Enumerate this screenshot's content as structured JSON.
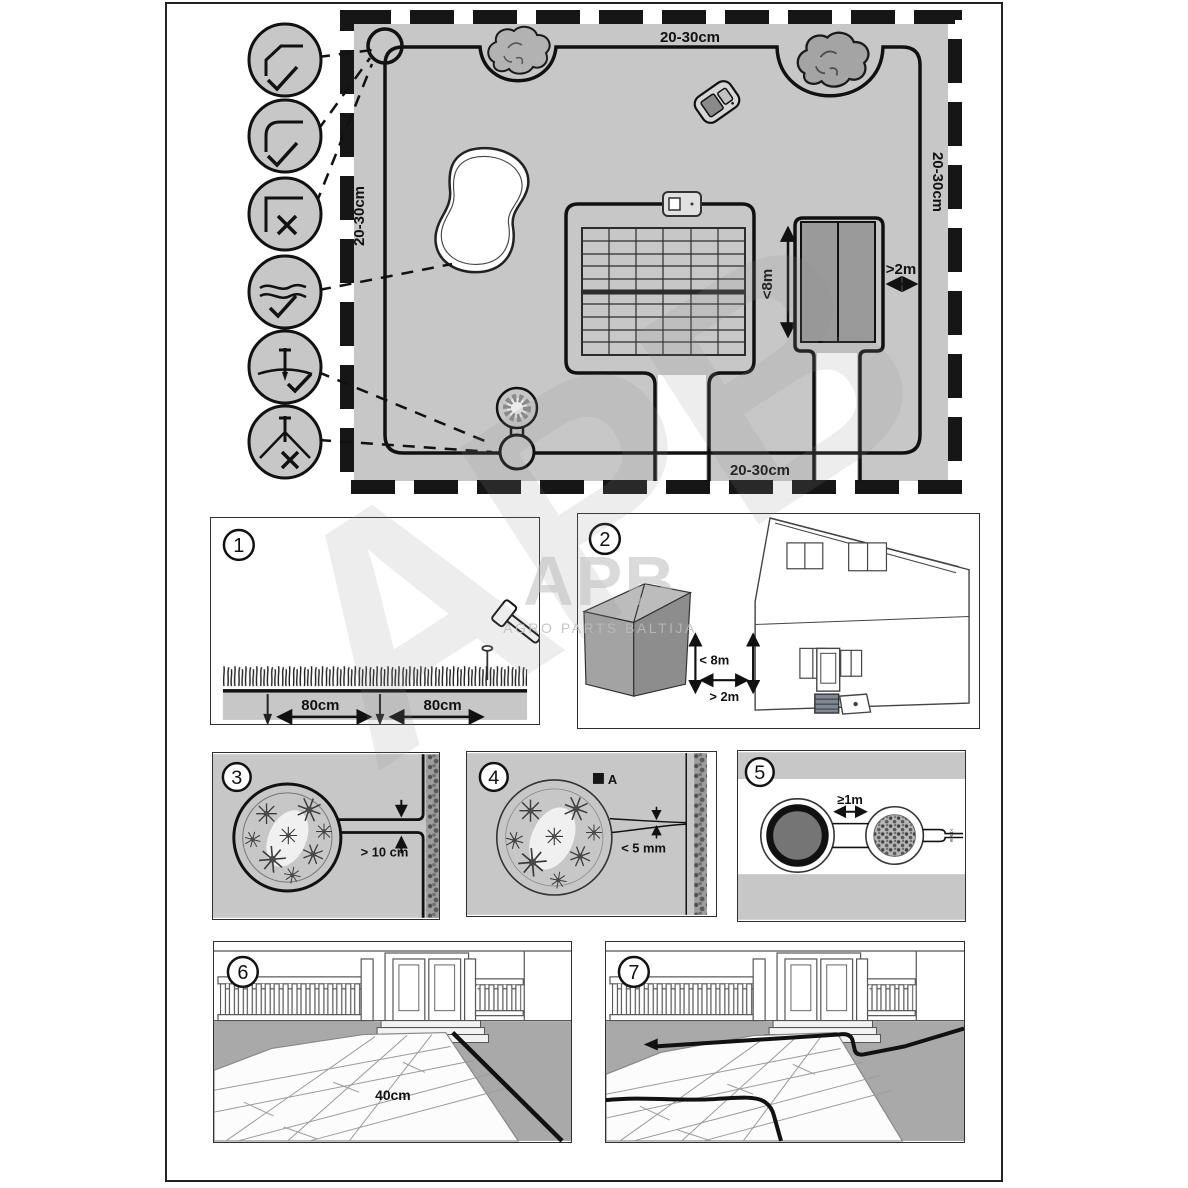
{
  "watermark": {
    "logo": "APB",
    "caption": "AGRO PARTS BALTIJA",
    "ghost": "APB"
  },
  "overview": {
    "margin_top": "20-30cm",
    "margin_left": "20-30cm",
    "margin_right": "20-30cm",
    "margin_bottom": "20-30cm",
    "shed_height": "<8m",
    "shed_gap": ">2m",
    "callout_icons": [
      "corner-chamfered-ok",
      "corner-rounded-ok",
      "corner-sharp-bad",
      "wire-splice-ok",
      "peg-flat-wire-ok",
      "peg-taut-wire-bad"
    ]
  },
  "panels": {
    "p1": {
      "num": "1",
      "dim_left": "80cm",
      "dim_right": "80cm"
    },
    "p2": {
      "num": "2",
      "height": "< 8m",
      "gap": "> 2m"
    },
    "p3": {
      "num": "3",
      "gap": "> 10 cm"
    },
    "p4": {
      "num": "4",
      "point": "A",
      "gap": "< 5 mm"
    },
    "p5": {
      "num": "5",
      "gap": "≥1m",
      "neck": ">10cm"
    },
    "p6": {
      "num": "6",
      "width": "40cm"
    },
    "p7": {
      "num": "7"
    }
  }
}
